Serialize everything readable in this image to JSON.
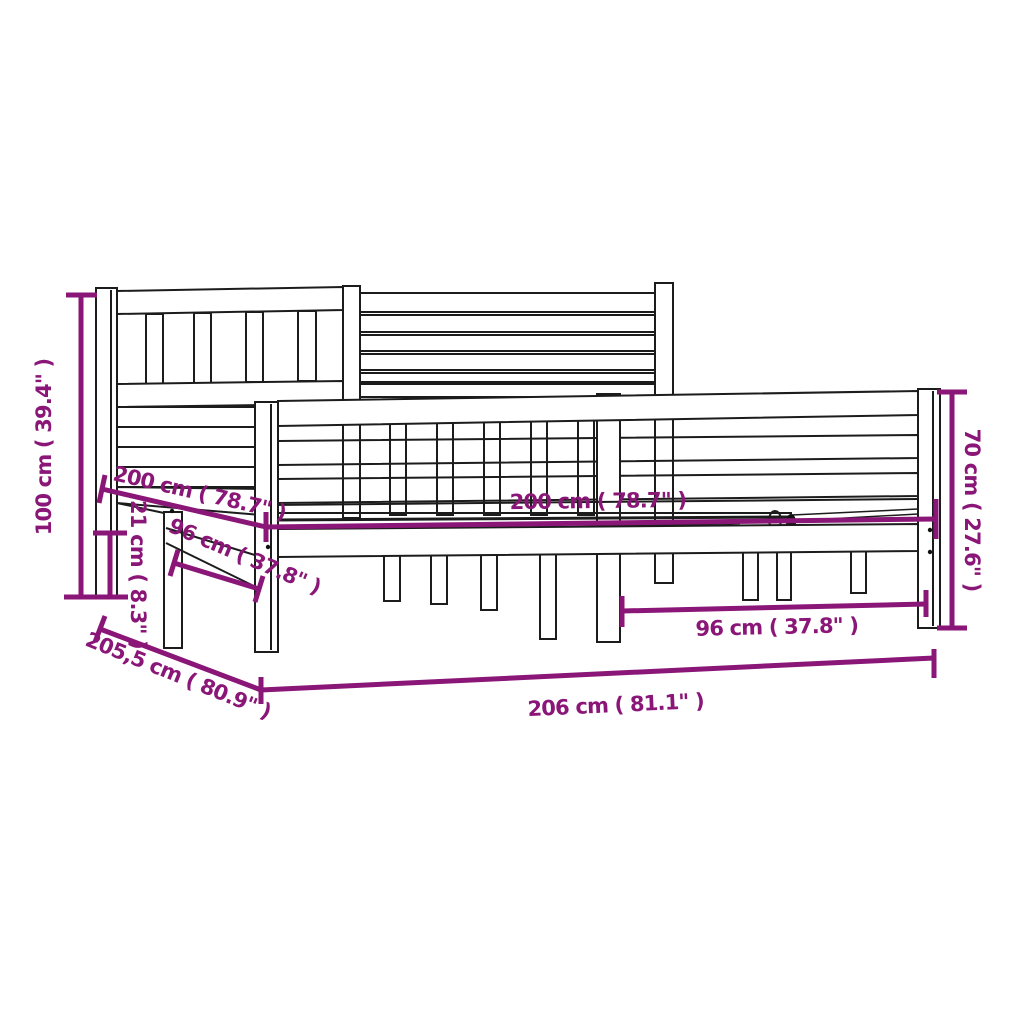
{
  "page": {
    "background_color": "#ffffff",
    "type": "product-dimension-diagram",
    "subject": "bed-frame-line-drawing"
  },
  "style": {
    "line_color": "#1c1c1c",
    "dimension_color": "#8A1677"
  },
  "dimensions": {
    "headboard_height": "100 cm ( 39.4\" )",
    "length_left": "200 cm ( 78.7\" )",
    "side_rail_height": "21 cm ( 8.3\" )",
    "leg_span_left": "96 cm ( 37.8\" )",
    "width_center": "200 cm ( 78.7\" )",
    "footboard_height": "70 cm ( 27.6\" )",
    "leg_span_right": "96 cm ( 37.8\" )",
    "depth_overall": "205,5 cm ( 80.9\" )",
    "width_overall": "206 cm ( 81.1\" )"
  }
}
